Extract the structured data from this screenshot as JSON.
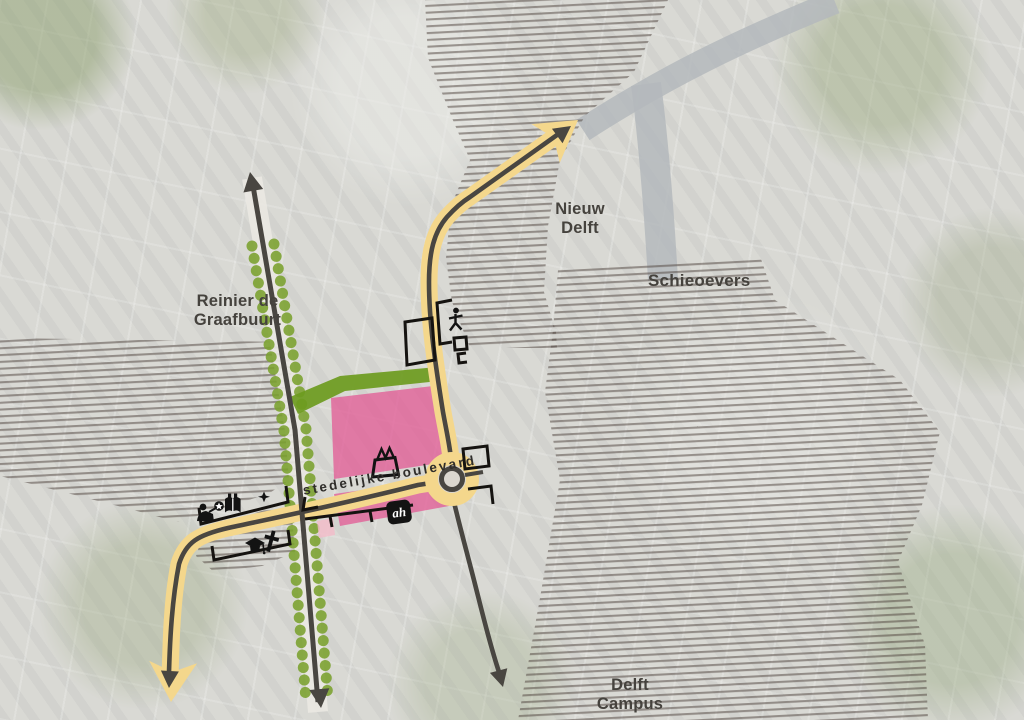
{
  "map": {
    "area_labels": {
      "reinier_de_graafbuurt": "Reinier de\nGraafbuurt",
      "nieuw_delft": "Nieuw\nDelft",
      "schieoevers": "Schieoevers",
      "delft_campus": "Delft\nCampus"
    },
    "route_labels": {
      "stedelijke_boulevard": "stedelijke boulevard"
    },
    "logo": {
      "ah": "ah"
    },
    "colors": {
      "route_yellow": "#f4d78c",
      "arrow_dark": "#494641",
      "rail_green": "#7aa12d",
      "strip_green": "#6d9b1e",
      "area_pink": "#e25e96",
      "area_pink_light": "#f2bac8",
      "hatch_line": "#4e423b",
      "water": "#b4b8bc",
      "label_text": "#45423d",
      "outline_black": "#151310"
    },
    "icons": [
      "lectern-person-icon",
      "star-badge-icon",
      "open-book-icon",
      "crescent-star-icon",
      "graduation-cap-icon",
      "latin-cross-icon",
      "shopping-basket-icon",
      "ah-logo",
      "activity-person-icon"
    ]
  }
}
